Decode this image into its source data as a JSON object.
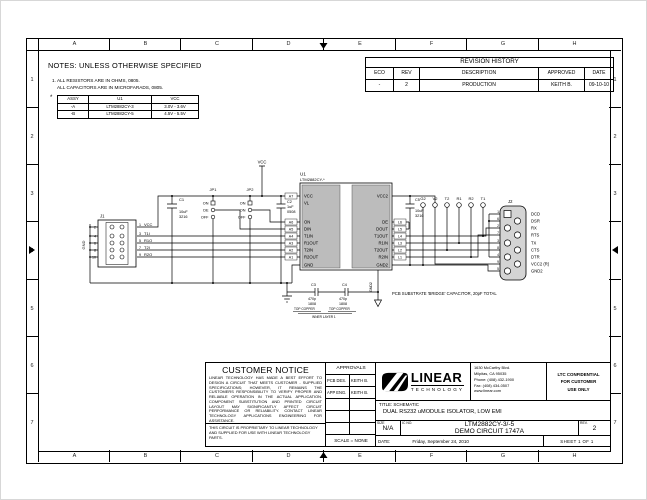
{
  "frame": {
    "cols": [
      "A",
      "B",
      "C",
      "D",
      "E",
      "F",
      "G",
      "H"
    ],
    "rows": [
      "1",
      "2",
      "3",
      "4",
      "5",
      "6",
      "7"
    ]
  },
  "notes": {
    "title": "NOTES:  UNLESS OTHERWISE SPECIFIED",
    "note1": "1. ALL RESISTORS ARE IN OHMS, 0805.",
    "note2": "ALL CAPACITORS ARE IN MICROFARADS, 0805.",
    "star": "*",
    "assy_table": {
      "headers": [
        "ASSY",
        "U1",
        "VCC"
      ],
      "rows": [
        [
          "-A",
          "LTM2882CY-3",
          "3.0V - 3.6V"
        ],
        [
          "-B",
          "LTM2882CY-5",
          "4.5V - 5.5V"
        ]
      ]
    }
  },
  "revision": {
    "title": "REVISION HISTORY",
    "headers": [
      "ECO",
      "REV",
      "DESCRIPTION",
      "APPROVED",
      "DATE"
    ],
    "rows": [
      [
        "-",
        "2",
        "PRODUCTION",
        "KEITH B.",
        "09-10-10"
      ]
    ]
  },
  "sch": {
    "vcc": "VCC",
    "gnd": "GND",
    "gnd2": "GND2",
    "u1_ref": "U1",
    "u1_part": "LTM2882CY-*",
    "u1_left": [
      "VCC",
      "VL",
      "ON",
      "DIN",
      "T1IN",
      "R1OUT",
      "T2IN",
      "R2OUT",
      "GND"
    ],
    "u1_right": [
      "VCC2",
      "DE",
      "DOUT",
      "T1OUT",
      "R1IN",
      "T2OUT",
      "R2IN",
      "GND2"
    ],
    "nets_left": [
      "A7",
      "A6",
      "A5",
      "A4",
      "A3",
      "A2",
      "A1"
    ],
    "nets_right": [
      "L6",
      "L5",
      "L4",
      "L3",
      "L2",
      "L1"
    ],
    "j1_ref": "J1",
    "j1_left": [
      "2",
      "4",
      "6",
      "8",
      "10"
    ],
    "j1_right": [
      "1",
      "3",
      "5",
      "7",
      "9"
    ],
    "j1_sig": [
      "VCC",
      "T1I",
      "R1O",
      "T2I",
      "R2O"
    ],
    "jp1_ref": "JP1",
    "jp2_ref": "JP2",
    "jp_top": "ON",
    "jp1_mid": "DE",
    "jp2_mid": "ON",
    "jp_bot": "OFF",
    "c1_ref": "C1",
    "c1_v": "10uF",
    "c1_p": "3216",
    "c2_ref": "C2",
    "c2_v": "1uF",
    "c2_p": "0508",
    "c3_ref": "C3",
    "c3_v": "470p",
    "c3_p": "1808",
    "c4_ref": "C4",
    "c4_v": "470p",
    "c4_p": "1808",
    "c5_ref": "C5",
    "c5_v": "10uF",
    "c5_p": "3216",
    "tp": [
      "G2",
      "V2",
      "T2",
      "R1",
      "R2",
      "T1"
    ],
    "j2_ref": "J2",
    "j2_nums": [
      "1",
      "6",
      "2",
      "7",
      "3",
      "8",
      "4",
      "9",
      "5"
    ],
    "j2_sigs": [
      "DCD",
      "DSR",
      "RX",
      "RTS",
      "TX",
      "CTS",
      "DTR",
      "VCC2 (R)",
      "GND2"
    ],
    "top_copper": "TOP COPPER",
    "inner_layer": "INNER LAYER 1",
    "bridge_note": "PCB SUBSTRATE 'BRIDGE' CAPACITOR, 20pF TOTAL"
  },
  "customer_notice": {
    "title": "CUSTOMER NOTICE",
    "body": "LINEAR TECHNOLOGY HAS MADE A BEST EFFORT TO DESIGN A CIRCUIT THAT MEETS CUSTOMER - SUPPLIED SPECIFICATIONS; HOWEVER, IT REMAINS THE CUSTOMERS RESPONSIBILITY TO VERIFY PROPER AND RELIABLE OPERATION IN THE ACTUAL APPLICATION. COMPONENT SUBSTITUTION AND PRINTED CIRCUIT LAYOUT MAY SIGNIFICANTLY AFFECT CIRCUIT PERFORMANCE OR RELIABILITY. CONTACT LINEAR TECHNOLOGY APPLICATIONS ENGINEERING FOR ASSISTANCE.",
    "proprietary": "THIS CIRCUIT IS PROPRIETARY TO LINEAR TECHNOLOGY AND SUPPLIED FOR USE WITH LINEAR TECHNOLOGY PARTS."
  },
  "approvals": {
    "title": "APPROVALS",
    "rows": [
      [
        "PCB DES.",
        "KEITH B."
      ],
      [
        "APP ENG.",
        "KEITH B."
      ]
    ],
    "scale": "SCALE = NONE"
  },
  "title_block": {
    "company": "LINEAR",
    "company_sub": "TECHNOLOGY",
    "address_lines": [
      "1630 McCarthy Blvd.",
      "Milpitas, CA 95035",
      "Phone: (408) 432-1900",
      "Fax: (408) 434-0507",
      "www.linear.com"
    ],
    "confidential_lines": [
      "LTC CONFIDENTIAL",
      "FOR CUSTOMER",
      "USE ONLY"
    ],
    "title_label": "TITLE: SCHEMATIC",
    "title": "DUAL RS232 uMODULE ISOLATOR, LOW EMI",
    "size_label": "SIZE",
    "size": "N/A",
    "icno_label": "IC NO.",
    "part": "LTM2882CY-3/-5",
    "demo": "DEMO CIRCUIT 1747A",
    "rev_label": "REV.",
    "rev": "2",
    "date_label": "DATE:",
    "date": "Friday, September 24, 2010",
    "sheet": "SHEET  1  OF  1"
  },
  "colors": {
    "chip_fill": "#bcbcbc",
    "connector_fill": "#d4d4d4",
    "line": "#000000"
  }
}
